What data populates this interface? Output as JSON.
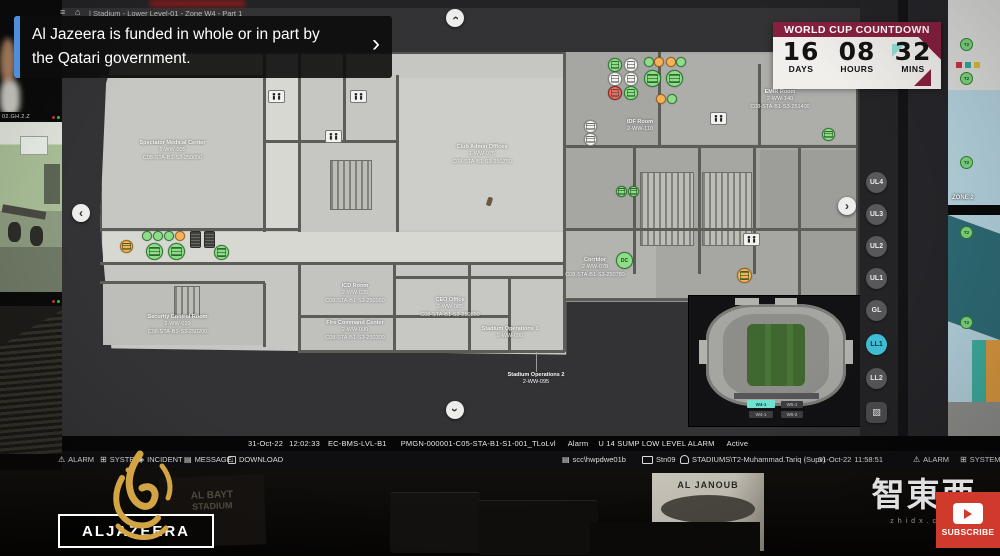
{
  "video": {
    "banner": {
      "line1": "Al Jazeera is funded in whole or in part by",
      "line2": "the Qatari government.",
      "chevron": "›"
    },
    "channel_logo_text": "ALJAZEERA",
    "subscribe_label": "SUBSCRIBE",
    "watermark": {
      "text": "智東西",
      "site": "zhidx.com"
    },
    "poster_left": {
      "line1": "AL BAYT",
      "line2": "STADIUM"
    },
    "poster_right": {
      "line1": "AL JANOUB",
      "line2": "STADIUM"
    }
  },
  "cameras": {
    "cam1_title": "02.GH.2.Z"
  },
  "screen": {
    "breadcrumb": {
      "menu_icon": "≡",
      "home_icon": "⌂",
      "path": "| Stadium - Lower Level-01 - Zone W4 - Part 1"
    },
    "countdown": {
      "title": "WORLD CUP COUNTDOWN",
      "days": "16",
      "days_label": "DAYS",
      "hours": "08",
      "hours_label": "HOURS",
      "mins": "32",
      "mins_label": "MINS"
    },
    "levels": {
      "buttons": [
        "UL4",
        "UL3",
        "UL2",
        "UL1",
        "GL",
        "LL1",
        "LL2"
      ],
      "active": "LL1"
    },
    "floorplan": {
      "dc_marker": "DC",
      "rooms": [
        {
          "name": "Spectator Medical Center",
          "id": "1-WW-005",
          "code": "C08-STA-B1-S3-250050"
        },
        {
          "name": "Club Admin Offices",
          "id": "1-WW-075",
          "code": "C08-STA-B1-S3-250750"
        },
        {
          "name": "EMIR Room",
          "id": "2-WW-140",
          "code": "C08-STA-B1-S3-251400"
        },
        {
          "name": "IDF Room",
          "id": "2-WW-110"
        },
        {
          "name": "Corridor",
          "id": "2-WW-078",
          "code": "C08-STA-B1-S3-250780"
        },
        {
          "name": "Security Control Room",
          "id": "2-WW-020",
          "code": "C08-STA-B1-S3-250200"
        },
        {
          "name": "ICD Room",
          "id": "2-WW-035",
          "code": "C08-STA-B1-S3-250950"
        },
        {
          "name": "Fire Command Center",
          "id": "2-WW-090",
          "code": "C08-STA-B1-S3-250300"
        },
        {
          "name": "CEO Office",
          "id": "2-WW-085",
          "code": "C08-STA-B1-S3-250850"
        },
        {
          "name": "Stadium Operations 1",
          "id": "2-WW-090"
        },
        {
          "name": "Stadium Operations 2",
          "id": "2-WW-095"
        }
      ]
    },
    "minimap": {
      "zones": [
        "W4-1",
        "W5-1",
        "W4-1",
        "W5-2"
      ],
      "active_zone": "W4-1"
    },
    "zone_panel": {
      "label": "ZONE 2",
      "marker": "T2"
    },
    "statusline": {
      "date": "31-Oct-22",
      "time": "12:02:33",
      "source": "EC-BMS-LVL-B1",
      "point": "PMGN-000001-C05-STA-B1-S1-001_TLoLvl",
      "type": "Alarm",
      "message": "U 14 SUMP LOW LEVEL ALARM",
      "state": "Active"
    },
    "toolbar": {
      "items": [
        "ALARM",
        "SYSTEM",
        "INCIDENT",
        "MESSAGE",
        "DOWNLOAD"
      ],
      "server": "scc\\hwpdwe01b",
      "station": "Stn09",
      "user": "STADIUMS\\T2-Muhammad.Tariq (Supv)",
      "date": "31-Oct-22",
      "time": "11:58:51",
      "right_items": [
        "ALARM",
        "SYSTEM"
      ]
    }
  }
}
